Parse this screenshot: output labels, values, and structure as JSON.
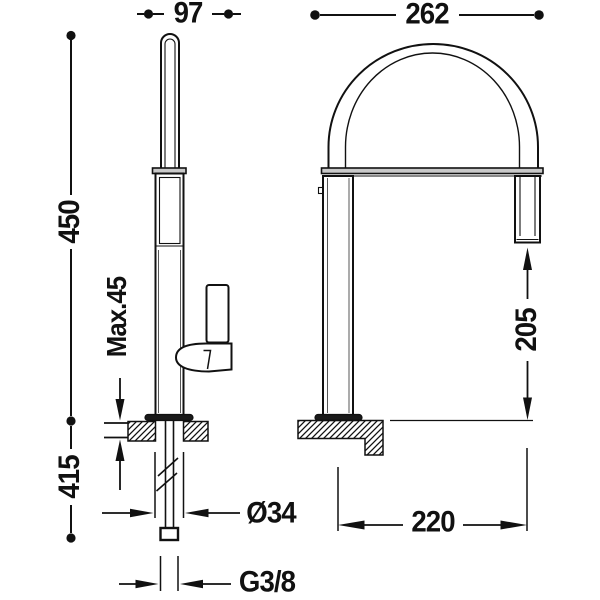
{
  "drawing": {
    "type": "technical-dimension-drawing",
    "subject": "kitchen-faucet-two-views",
    "colors": {
      "line": "#111111",
      "background": "#ffffff",
      "bar_fill": "#c9c9c9",
      "solid_fill": "#1a1a1a"
    },
    "dimensions": {
      "spout_depth": "97",
      "arch_width": "262",
      "height_above_counter": "450",
      "max_counter_thickness": "Max.45",
      "under_counter_length": "415",
      "hole_diameter": "Ø34",
      "thread_size": "G3/8",
      "outlet_clearance": "205",
      "spout_reach": "220"
    }
  }
}
